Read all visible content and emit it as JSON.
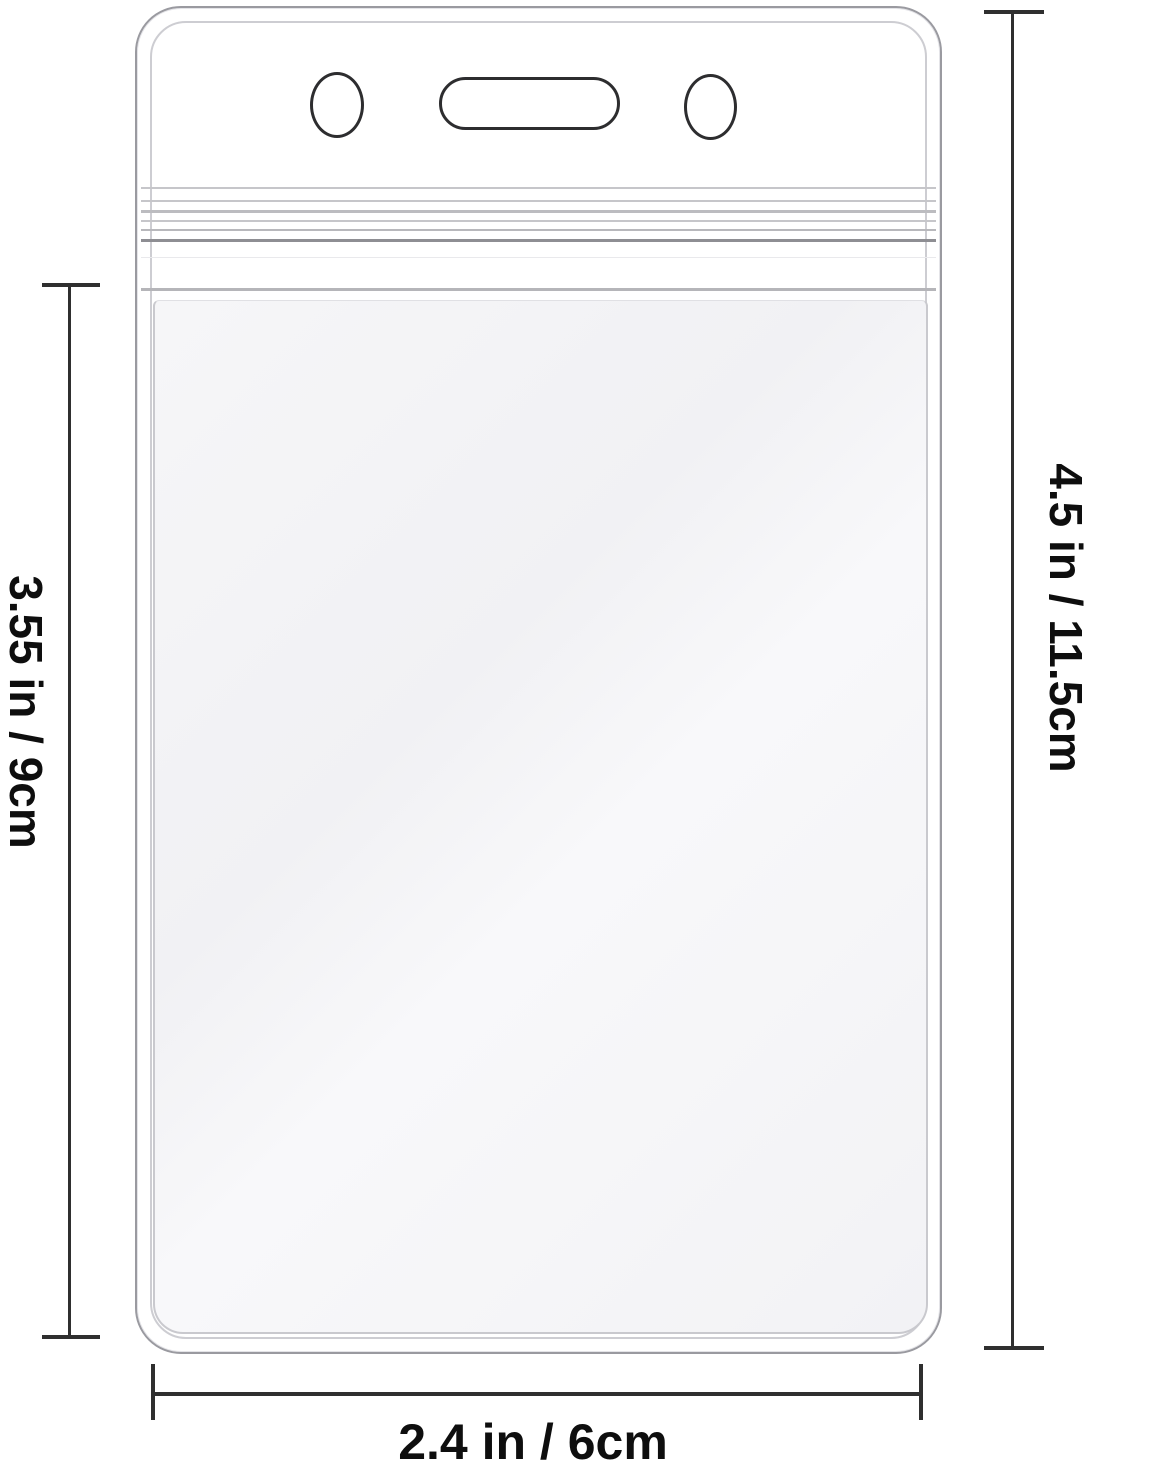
{
  "page": {
    "type": "product-dimension-diagram",
    "background": "#ffffff"
  },
  "product": {
    "name": "vertical clear ID badge holder",
    "parts": [
      "round-hole-left",
      "lanyard-slot",
      "round-hole-right",
      "zip-seal",
      "card-pocket"
    ]
  },
  "dimensions": {
    "pocket_height": {
      "label": "3.55 in / 9cm",
      "side": "left"
    },
    "overall_height": {
      "label": "4.5 in / 11.5cm",
      "side": "right"
    },
    "overall_width": {
      "label": "2.4 in / 6cm",
      "side": "bottom"
    }
  },
  "colors": {
    "dimension_line": "#2f2f2f",
    "label_text": "#0e0e0e",
    "holder_outline": "#9a9aa0",
    "inner_outline": "#cdcdd2",
    "hole_outline": "#2d2d2f",
    "zip_seal_line": "#8e8e93",
    "pocket_fill": "#f4f4f6"
  }
}
